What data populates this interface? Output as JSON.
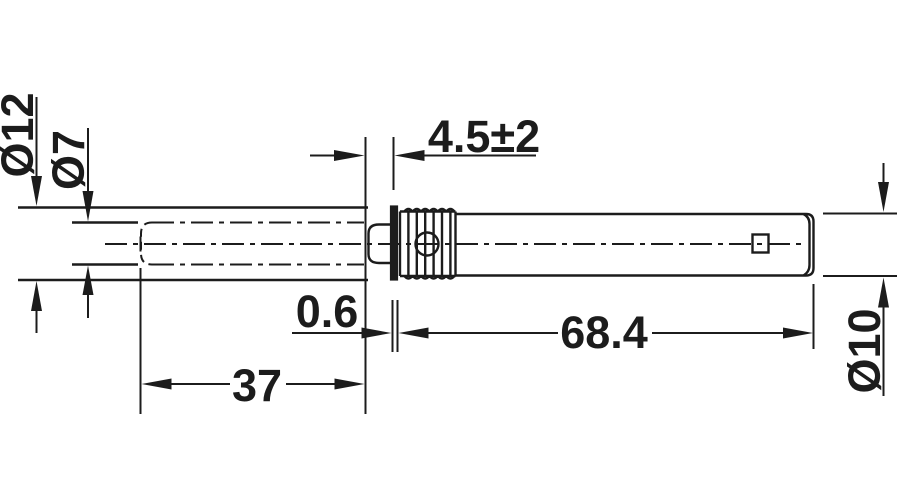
{
  "canvas": {
    "background": "#ffffff",
    "line_color": "#1c1c1c"
  },
  "dimensions": {
    "sleeve_bore_diameter": {
      "label": "Ø12"
    },
    "plunger_diameter": {
      "label": "Ø7"
    },
    "adjustment_projection": {
      "label": "4.5±2"
    },
    "flange_thickness": {
      "label": "0.6"
    },
    "housing_length": {
      "label": "68.4"
    },
    "bore_depth": {
      "label": "37"
    },
    "housing_diameter": {
      "label": "Ø10"
    }
  }
}
